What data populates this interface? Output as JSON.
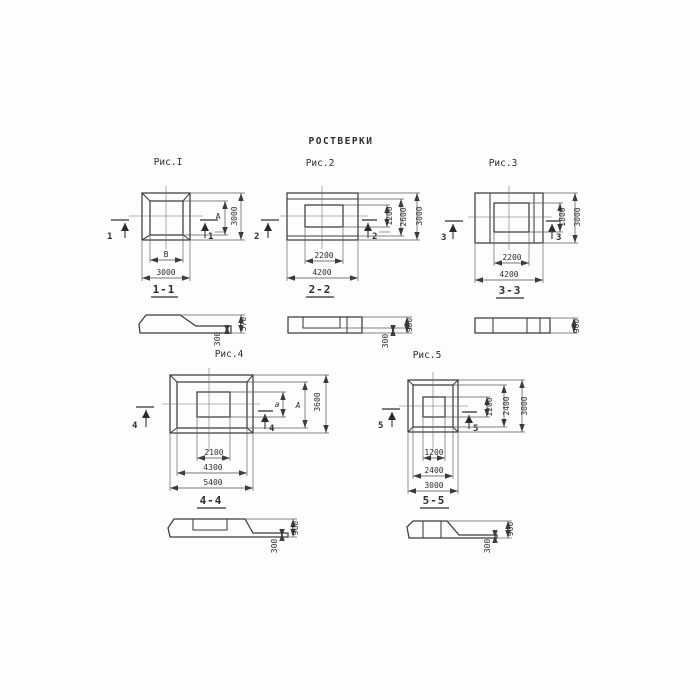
{
  "title": "РОСТВЕРКИ",
  "figures": [
    {
      "id": "fig1",
      "label": "Рис.I",
      "section_label": "1-1",
      "marker": "1",
      "plan_dims": {
        "bottom_inner": "В",
        "bottom_outer": "3000",
        "right_inner": "А",
        "right_outer": "3000"
      },
      "section_dims": {
        "height": "570",
        "tail": "300"
      }
    },
    {
      "id": "fig2",
      "label": "Рис.2",
      "section_label": "2-2",
      "marker": "2",
      "plan_dims": {
        "bottom_inner": "2200",
        "bottom_outer": "4200",
        "right_inner": "1200",
        "right_mid": "2600",
        "right_outer": "3000"
      },
      "section_dims": {
        "height": "900",
        "tail": "300"
      }
    },
    {
      "id": "fig3",
      "label": "Рис.3",
      "section_label": "3-3",
      "marker": "3",
      "plan_dims": {
        "bottom_inner": "2200",
        "bottom_outer": "4200",
        "right_inner": "1800",
        "right_outer": "3000"
      },
      "section_dims": {
        "height": "900"
      }
    },
    {
      "id": "fig4",
      "label": "Рис.4",
      "section_label": "4-4",
      "marker": "4",
      "plan_dims": {
        "bottom_inner": "2100",
        "bottom_mid": "4300",
        "bottom_outer": "5400",
        "right_inner": "a",
        "right_mid": "А",
        "right_outer": "3600"
      },
      "section_dims": {
        "height": "900",
        "tail": "300"
      }
    },
    {
      "id": "fig5",
      "label": "Рис.5",
      "section_label": "5-5",
      "marker": "5",
      "plan_dims": {
        "bottom_inner": "1200",
        "bottom_mid": "2400",
        "bottom_outer": "3000",
        "right_inner": "1200",
        "right_mid": "2400",
        "right_outer": "3000"
      },
      "section_dims": {
        "height": "900",
        "tail": "300"
      }
    }
  ]
}
